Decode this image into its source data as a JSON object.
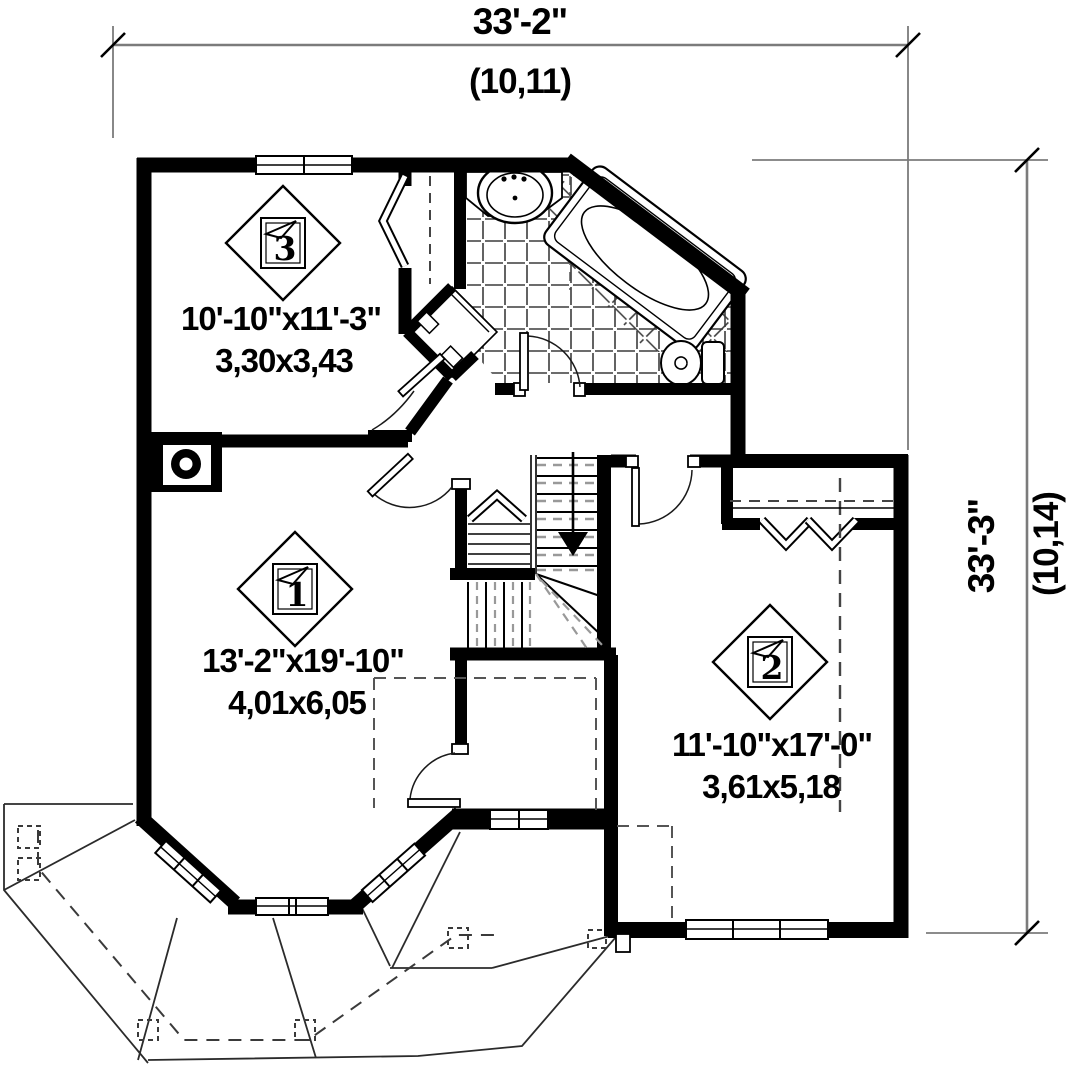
{
  "drawing": {
    "title": "second-floor-plan",
    "dim_top": {
      "label": "33'-2\"",
      "sub": "(10,11)"
    },
    "dim_right": {
      "label": "33'-3\"",
      "sub": "(10,14)"
    },
    "rooms": [
      {
        "number": "1",
        "size_imperial": "13'-2\"x19'-10\"",
        "size_metric": "4,01x6,05"
      },
      {
        "number": "2",
        "size_imperial": "11'-10\"x17'-0\"",
        "size_metric": "3,61x5,18"
      },
      {
        "number": "3",
        "size_imperial": "10'-10\"x11'-3\"",
        "size_metric": "3,30x3,43"
      }
    ],
    "colors": {
      "wall": "#000000",
      "dimension_line": "#7b7b7b",
      "thin_line": "#1a1a1a",
      "dashed_roof_line": "#3a3a3a",
      "stair_dash": "#999999",
      "background": "#ffffff"
    }
  }
}
